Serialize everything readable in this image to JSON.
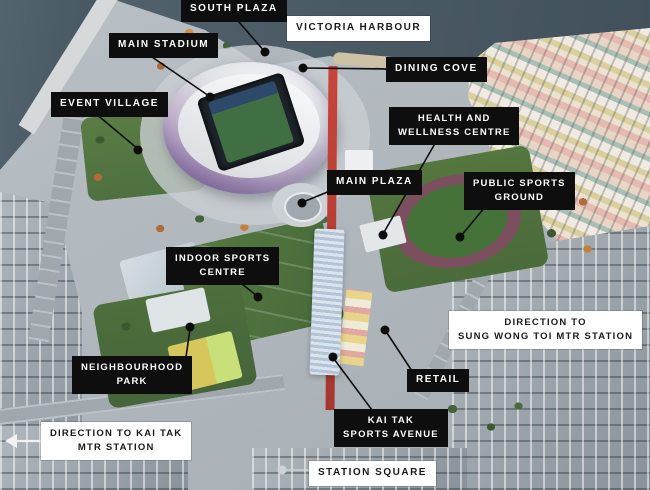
{
  "map": {
    "title": "Kai Tak Sports Park aerial overview",
    "labels": {
      "south_plaza": "SOUTH PLAZA",
      "victoria_harbour": "VICTORIA HARBOUR",
      "main_stadium": "MAIN STADIUM",
      "dining_cove": "DINING COVE",
      "event_village": "EVENT VILLAGE",
      "health_and_wellness_centre": [
        "HEALTH AND",
        "WELLNESS CENTRE"
      ],
      "main_plaza": "MAIN PLAZA",
      "public_sports_ground": [
        "PUBLIC SPORTS",
        "GROUND"
      ],
      "indoor_sports_centre": [
        "INDOOR SPORTS",
        "CENTRE"
      ],
      "direction_sung_wong_toi": [
        "DIRECTION TO",
        "SUNG WONG TOI MTR STATION"
      ],
      "neighbourhood_park": [
        "NEIGHBOURHOOD",
        "PARK"
      ],
      "retail": "RETAIL",
      "direction_kai_tak": [
        "DIRECTION TO KAI TAK",
        "MTR STATION"
      ],
      "kai_tak_sports_avenue": [
        "KAI TAK",
        "SPORTS AVENUE"
      ],
      "station_square": "STATION SQUARE"
    },
    "icons": {
      "direction_kai_tak_arrow": "left-arrow"
    },
    "colors": {
      "label_dark_bg": "#0e0e0e",
      "label_dark_text": "#ffffff",
      "label_light_bg": "#ffffff",
      "label_light_text": "#1a1a1a",
      "leader_line": "#0d0d0d",
      "avenue_red": "#c8453a",
      "harbour_water": "#4e5f6c",
      "pitch_green": "#447239",
      "stadium_purple": "#957ead"
    }
  }
}
